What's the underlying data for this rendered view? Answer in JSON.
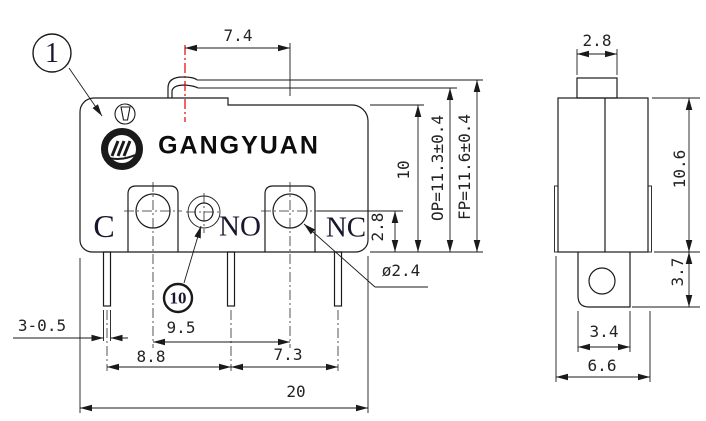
{
  "brand": {
    "logo_text": "GANGYUAN"
  },
  "balloons": {
    "part1": "1",
    "part10": "10"
  },
  "front": {
    "labels": {
      "common": "C",
      "normally_open": "NO",
      "normally_closed": "NC"
    },
    "dims": {
      "plunger_offset": "7.4",
      "height": "10",
      "operating_position": "OP=11.3±0.4",
      "free_position": "FP=11.6±0.4",
      "hole_center_to_bottom": "2.8",
      "mount_hole_dia": "ø2.4",
      "terminal_thickness": "3-0.5",
      "mount_hole_spacing": "9.5",
      "pitch_c_no": "8.8",
      "pitch_no_nc": "7.3",
      "width": "20"
    }
  },
  "side": {
    "dims": {
      "plunger_width": "2.8",
      "height": "10.6",
      "bracket_height": "3.7",
      "bracket_width": "3.4",
      "depth": "6.6"
    }
  },
  "colors": {
    "line": "#1a1a1a",
    "text": "#232323",
    "centerline_red": "#e60000"
  }
}
